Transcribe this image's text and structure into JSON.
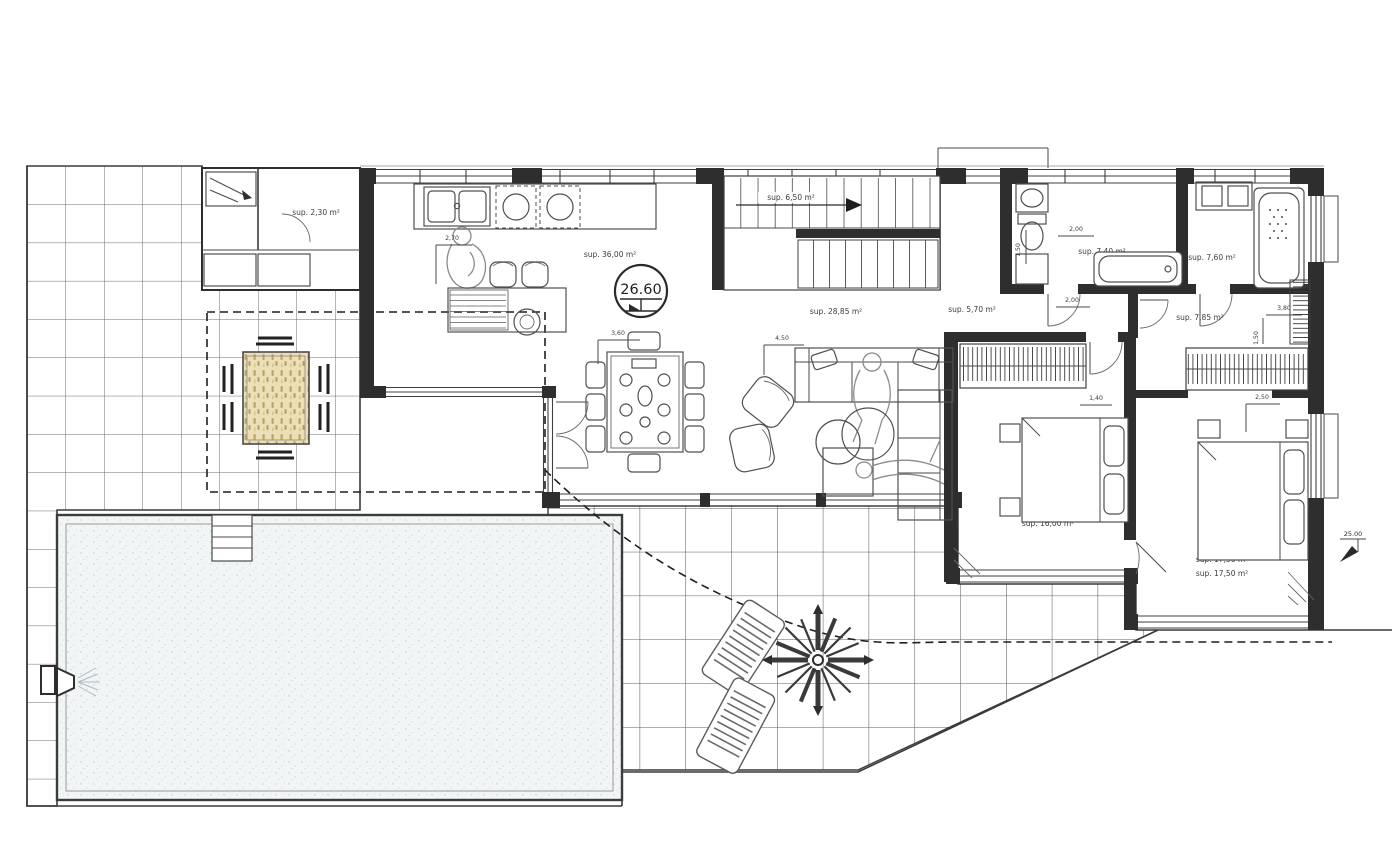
{
  "drawing": {
    "type": "architectural-floor-plan",
    "level_markers": {
      "interior": "26.60",
      "exterior": "25.00"
    },
    "rooms": [
      {
        "name": "storage-porch",
        "area_label": "sup. 2,30 m²"
      },
      {
        "name": "kitchen-living",
        "area_label": "sup. 36,00 m²"
      },
      {
        "name": "staircase",
        "area_label": "sup. 6,50 m²"
      },
      {
        "name": "living-room",
        "area_label": "sup. 28,85 m²"
      },
      {
        "name": "hallway",
        "area_label": "sup. 5,70 m²"
      },
      {
        "name": "bathroom-1",
        "area_label": "sup. 7,40 m²"
      },
      {
        "name": "bathroom-2",
        "area_label": "sup. 7,60 m²"
      },
      {
        "name": "dressing-room",
        "area_label": "sup. 7,85 m²"
      },
      {
        "name": "bedroom-1",
        "area_label": "sup. 16,00 m²"
      },
      {
        "name": "bedroom-2-a",
        "area_label": "sup. 17,50 m²"
      },
      {
        "name": "bedroom-2-b",
        "area_label": "sup. 17,50 m²"
      }
    ],
    "dimensions": {
      "kitchen_width": "2,70",
      "dining_width": "3,60",
      "sofa_width": "4,50",
      "bath1_width": "2,00",
      "bath1_depth": "1,50",
      "hall_width": "2,00",
      "dressing_width": "3,80",
      "dressing_depth": "1,50",
      "bed1_width": "1,40",
      "bed2_width": "2,50"
    }
  },
  "colors": {
    "line": "#2e2e2e",
    "grid": "#646464",
    "pool_water": "#f2f5f6",
    "wood_table": "#eadfb6",
    "dash": "#1e1e1e"
  }
}
